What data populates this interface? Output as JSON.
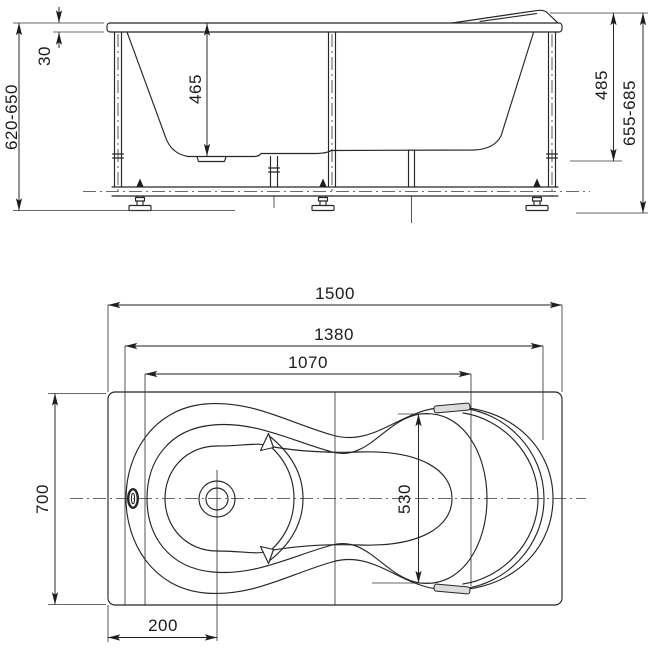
{
  "drawing": {
    "kind": "bathtub installation drawing — front elevation (top) and plan view (bottom)",
    "colors": {
      "line": "#262626",
      "background": "#ffffff"
    },
    "side_view": {
      "dims": {
        "rim_thickness": "30",
        "inner_depth_front": "465",
        "overall_height": "620-650",
        "inner_depth_back": "485",
        "overall_height_with_headrest": "655-685"
      }
    },
    "plan_view": {
      "dims": {
        "overall_length": "1500",
        "rim_inner_length": "1380",
        "basin_length": "1070",
        "overall_width": "700",
        "basin_width": "530",
        "drain_offset": "200"
      }
    }
  }
}
